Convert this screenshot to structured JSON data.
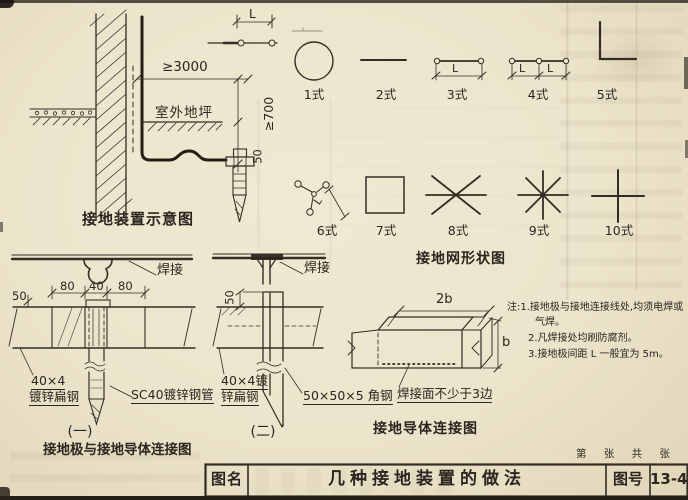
{
  "colors": {
    "paper": "#ece4cb",
    "ink": "#2b261f"
  },
  "schematic": {
    "caption": "接地装置示意图",
    "outdoor_ground_label": "室外地坪",
    "dim_wall_offset": "≥3000",
    "dim_burial_depth": "≥700",
    "dim_50": "50"
  },
  "grid_shapes": {
    "caption": "接地网形状图",
    "dim_l": "L",
    "row1": [
      {
        "label": "1式"
      },
      {
        "label": "2式"
      },
      {
        "label": "3式"
      },
      {
        "label": "4式"
      },
      {
        "label": "5式"
      }
    ],
    "row2": [
      {
        "label": "6式"
      },
      {
        "label": "7式"
      },
      {
        "label": "8式"
      },
      {
        "label": "9式"
      },
      {
        "label": "10式"
      }
    ]
  },
  "connection1": {
    "weld_label": "焊接",
    "dim_80_left": "80",
    "dim_40": "40",
    "dim_80_right": "80",
    "dim_50": "50",
    "flat_steel_line1": "40×4",
    "flat_steel_line2": "镀锌扁钢",
    "pipe_label": "SC40镀锌钢管",
    "number": "(一)",
    "caption": "接地极与接地导体连接图"
  },
  "connection2": {
    "weld_label": "焊接",
    "dim_50": "50",
    "flat_steel_line1": "40×4镀",
    "flat_steel_line2": "锌扁钢",
    "angle_steel_label": "50×50×5 角钢",
    "number": "(二)"
  },
  "conductor_joint": {
    "caption": "接地导体连接图",
    "dim_2b": "2b",
    "dim_b": "b",
    "weld_note": "焊接面不少于3边"
  },
  "notes": {
    "line1": "注:1.接地极与接地连接线处,均须电焊或",
    "line2": "气焊。",
    "line3": "2.凡焊接处均刷防腐剂。",
    "line4": "3.接地极间距 L 一般宜为 5m。"
  },
  "title_bar": {
    "name_label": "图名",
    "drawing_name": "几种接地装置的做法",
    "number_label": "图号",
    "drawing_number": "13-40",
    "sheet_counter": "第 张 共 张"
  }
}
